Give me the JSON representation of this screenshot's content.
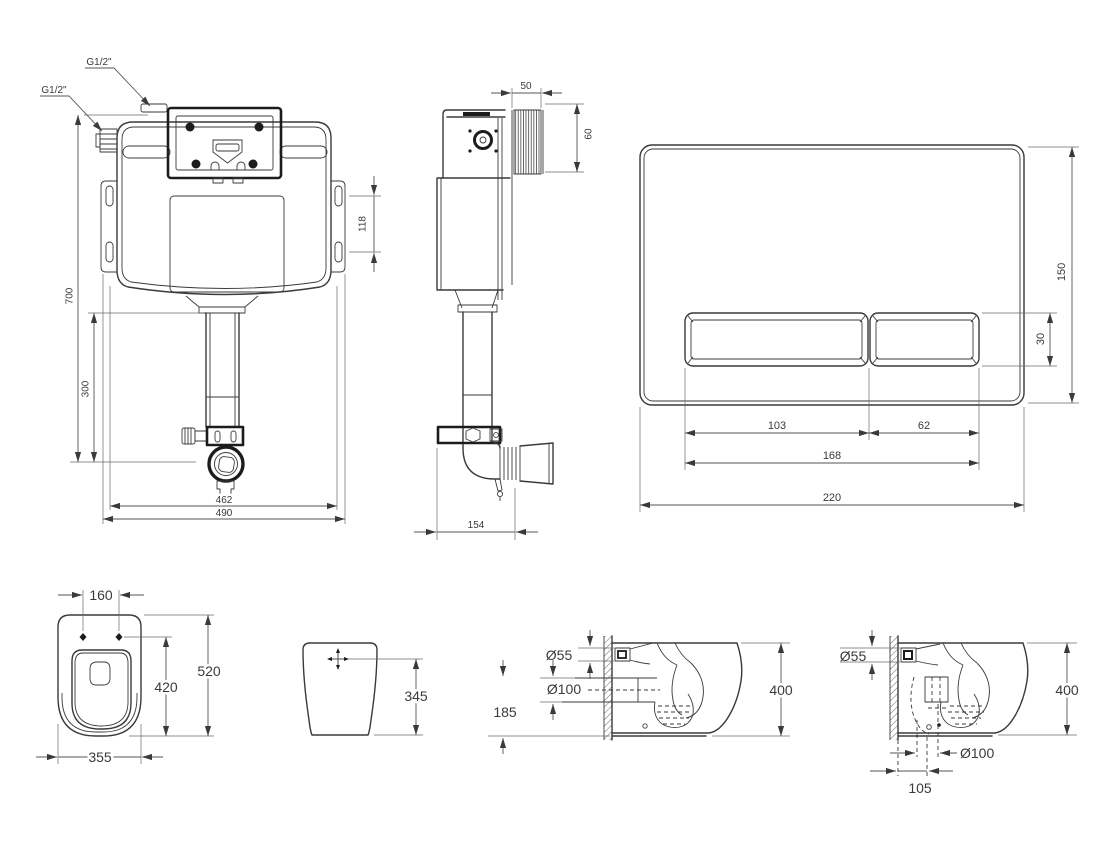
{
  "drawing": {
    "colors": {
      "line": "#3a3a3a",
      "dim": "#555555",
      "text": "#3a3a3a",
      "dark": "#1c1c1c",
      "background": "#ffffff"
    }
  },
  "views": {
    "cistern_front": {
      "annotations": {
        "inlet_top": "G1/2\"",
        "inlet_left": "G1/2\""
      },
      "dims": {
        "height": "700",
        "flush_bend_drop": "300",
        "bracket_slot_spacing": "118",
        "inner_width": "462",
        "overall_width": "490"
      }
    },
    "cistern_side": {
      "dims": {
        "shaft_depth": "50",
        "shaft_height": "60",
        "depth": "154"
      }
    },
    "flush_plate": {
      "dims": {
        "height": "150",
        "button_height": "30",
        "large_button_width": "103",
        "small_button_width": "62",
        "buttons_span": "168",
        "width": "220"
      }
    },
    "pan_top": {
      "dims": {
        "seat_hole_spacing": "160",
        "length": "520",
        "seat_holes_to_front": "420",
        "width": "355"
      }
    },
    "pan_front": {
      "dims": {
        "inlet_height": "345"
      }
    },
    "pan_side_wall_outlet": {
      "dims": {
        "inlet_diameter": "Ø55",
        "outlet_diameter": "Ø100",
        "outlet_height": "185",
        "height": "400"
      }
    },
    "pan_side_floor_outlet": {
      "dims": {
        "inlet_diameter": "Ø55",
        "height": "400",
        "outlet_diameter": "Ø100",
        "outlet_center_offset": "105"
      }
    }
  }
}
